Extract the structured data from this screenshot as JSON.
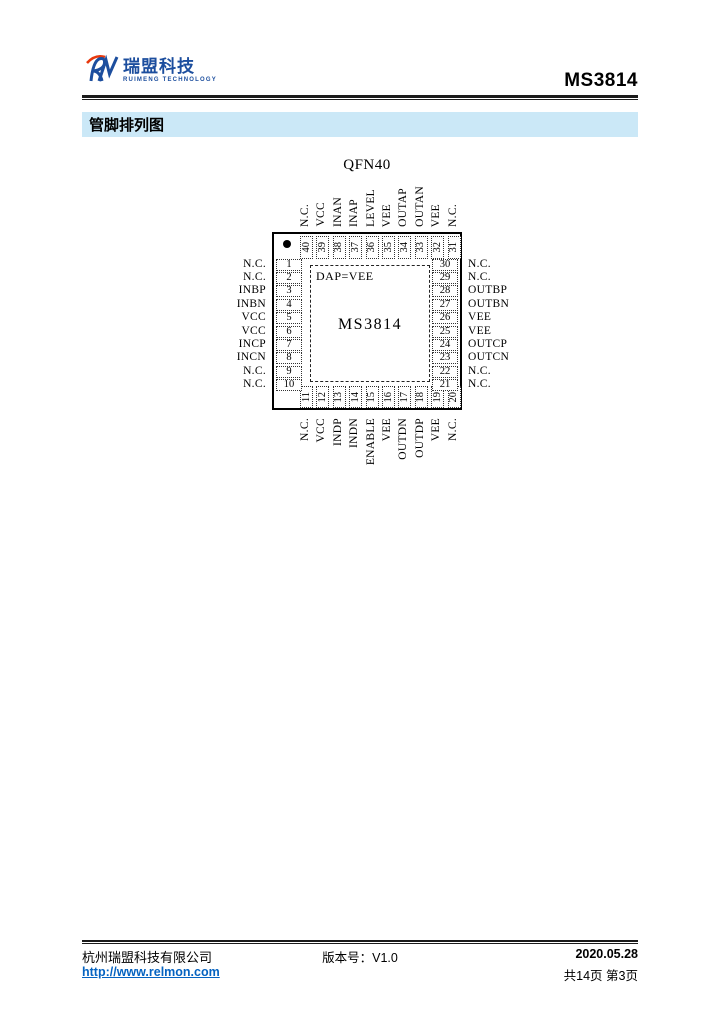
{
  "header": {
    "logo_zh": "瑞盟科技",
    "logo_en": "RUIMENG TECHNOLOGY",
    "product": "MS3814"
  },
  "section": {
    "title": "管脚排列图"
  },
  "diagram": {
    "package_label": "QFN40",
    "chip_name": "MS3814",
    "dap_note": "DAP=VEE",
    "pins": {
      "left": [
        {
          "num": "1",
          "label": "N.C."
        },
        {
          "num": "2",
          "label": "N.C."
        },
        {
          "num": "3",
          "label": "INBP"
        },
        {
          "num": "4",
          "label": "INBN"
        },
        {
          "num": "5",
          "label": "VCC"
        },
        {
          "num": "6",
          "label": "VCC"
        },
        {
          "num": "7",
          "label": "INCP"
        },
        {
          "num": "8",
          "label": "INCN"
        },
        {
          "num": "9",
          "label": "N.C."
        },
        {
          "num": "10",
          "label": "N.C."
        }
      ],
      "right": [
        {
          "num": "30",
          "label": "N.C."
        },
        {
          "num": "29",
          "label": "N.C."
        },
        {
          "num": "28",
          "label": "OUTBP"
        },
        {
          "num": "27",
          "label": "OUTBN"
        },
        {
          "num": "26",
          "label": "VEE"
        },
        {
          "num": "25",
          "label": "VEE"
        },
        {
          "num": "24",
          "label": "OUTCP"
        },
        {
          "num": "23",
          "label": "OUTCN"
        },
        {
          "num": "22",
          "label": "N.C."
        },
        {
          "num": "21",
          "label": "N.C."
        }
      ],
      "top": [
        {
          "num": "40",
          "label": "N.C."
        },
        {
          "num": "39",
          "label": "VCC"
        },
        {
          "num": "38",
          "label": "INAN"
        },
        {
          "num": "37",
          "label": "INAP"
        },
        {
          "num": "36",
          "label": "LEVEL"
        },
        {
          "num": "35",
          "label": "VEE"
        },
        {
          "num": "34",
          "label": "OUTAP"
        },
        {
          "num": "33",
          "label": "OUTAN"
        },
        {
          "num": "32",
          "label": "VEE"
        },
        {
          "num": "31",
          "label": "N.C."
        }
      ],
      "bottom": [
        {
          "num": "11",
          "label": "N.C."
        },
        {
          "num": "12",
          "label": "VCC"
        },
        {
          "num": "13",
          "label": "INDP"
        },
        {
          "num": "14",
          "label": "INDN"
        },
        {
          "num": "15",
          "label": "ENABLE"
        },
        {
          "num": "16",
          "label": "VEE"
        },
        {
          "num": "17",
          "label": "OUTDN"
        },
        {
          "num": "18",
          "label": "OUTDP"
        },
        {
          "num": "19",
          "label": "VEE"
        },
        {
          "num": "20",
          "label": "N.C."
        }
      ]
    }
  },
  "footer": {
    "company": "杭州瑞盟科技有限公司",
    "url": "http://www.relmon.com",
    "version": "版本号：V1.0",
    "date": "2020.05.28",
    "pages": "共14页 第3页"
  },
  "colors": {
    "brand_blue": "#1c4e9e",
    "brand_red": "#e8380d",
    "section_bar_bg": "#cbe8f7",
    "link_blue": "#0563c1",
    "ink": "#000000"
  }
}
